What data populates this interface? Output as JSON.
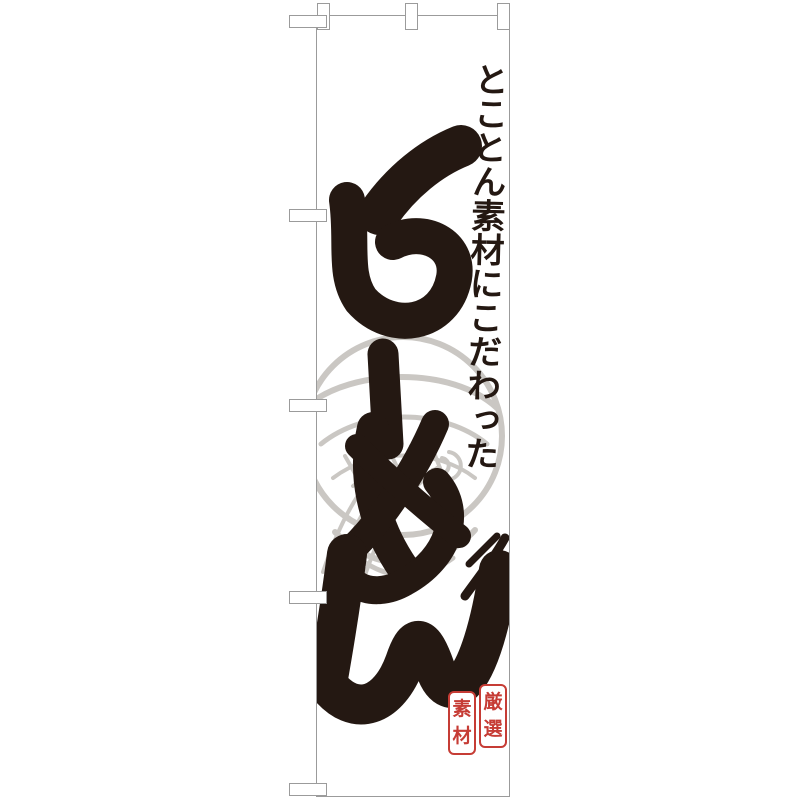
{
  "scene": {
    "background": "#ffffff",
    "kind": "nobori-flag-product-mockup"
  },
  "banner": {
    "background": "#ffffff",
    "outline_color": "#9b9b9b",
    "ink_color": "#241812",
    "catchphrase": "とことん素材にこだわった",
    "main_text": "らーめん",
    "illustration": {
      "name": "ramen-noodle-bowl-line-art",
      "color": "#cac7c3"
    },
    "seal": {
      "color": "#c63c35",
      "text": "厳選素材",
      "left_chars": [
        "素",
        "材"
      ],
      "right_chars": [
        "厳",
        "選"
      ]
    },
    "pole_tabs": {
      "top_count": 3,
      "left_count": 5
    }
  }
}
